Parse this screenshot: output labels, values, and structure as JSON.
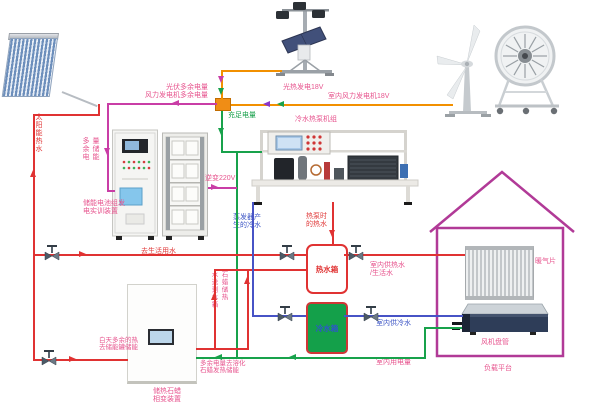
{
  "colors": {
    "red_water_line": "#e03232",
    "pink_power_line": "#c93da6",
    "orange_power_line": "#f29000",
    "green_power_line": "#18a24b",
    "blue_water_line": "#4753c6",
    "purple_arrow": "#8a35c9",
    "house_outline": "#b13a97",
    "junction_box": "#f08d15",
    "cold_tank_fill": "#14a04a"
  },
  "labels": {
    "pv_excess_1": "光伏多余电量",
    "pv_excess_2": "风力发电机多余电量",
    "pv_gen": "光热发电18V",
    "wind_gen": "室内风力发电机18V",
    "sufficient": "充足电量",
    "excess_store_col_left": "多余电",
    "excess_store_col_right": "量储能",
    "solar_hot_water": "太阳能热水",
    "storage_device_1": "储能电池组发",
    "storage_device_2": "电实训装置",
    "inverter": "逆变220V",
    "chiller_unit": "冷水热泵机组",
    "evap_1": "蒸发器产",
    "evap_2": "生的冷水",
    "hp_hot_1": "热泵时",
    "hp_hot_2": "的热水",
    "to_domestic": "去生活用水",
    "paraffin_col_right": "石蜡储热",
    "paraffin_col_left": "水送到水箱",
    "day_excess_1": "白天多余的热",
    "day_excess_2": "去储能罐储能",
    "paraffin_device_1": "储热石蜡",
    "paraffin_device_2": "相变装置",
    "excess_melt_1": "多余电量去溶化",
    "excess_melt_2": "石蜡发热储能",
    "indoor_power": "室内用电量",
    "hot_tank": "热水箱",
    "cold_tank": "冷水箱",
    "indoor_hot_1": "室内供热水",
    "indoor_hot_2": "/生活水",
    "indoor_cold": "室内供冷水",
    "radiator": "暖气片",
    "fan_coil": "风机盘管",
    "load_platform": "负载平台"
  }
}
